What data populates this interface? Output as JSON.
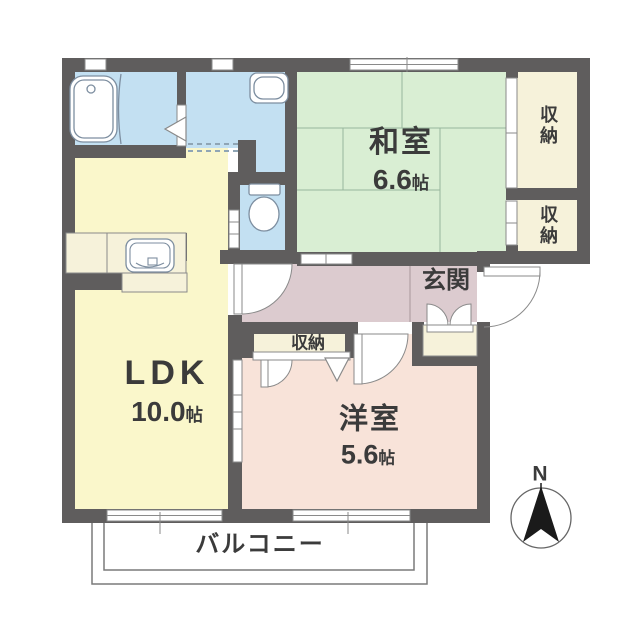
{
  "floorplan": {
    "rooms": {
      "washitsu": {
        "name": "和室",
        "size_value": "6.6",
        "size_unit": "帖"
      },
      "ldk": {
        "name": "LDK",
        "size_value": "10.0",
        "size_unit": "帖"
      },
      "youshitsu": {
        "name": "洋室",
        "size_value": "5.6",
        "size_unit": "帖"
      },
      "genkan": {
        "name": "玄関"
      },
      "balcony": {
        "name": "バルコニー"
      },
      "closet_upper": {
        "name": "収納"
      },
      "closet_lower": {
        "name": "収納"
      },
      "closet_youshitsu": {
        "name": "収納"
      }
    },
    "compass": {
      "north_label": "N"
    },
    "colors": {
      "wall": "#5f5d5d",
      "tatami_room": "#d9eed3",
      "ldk": "#faf7cb",
      "western_room": "#f8e3d9",
      "hall_entrance": "#dccbcf",
      "wet_rooms": "#c3e0f2",
      "closet": "#f6f2da",
      "line": "#8a8a8a",
      "text": "#3b3b3b"
    }
  }
}
